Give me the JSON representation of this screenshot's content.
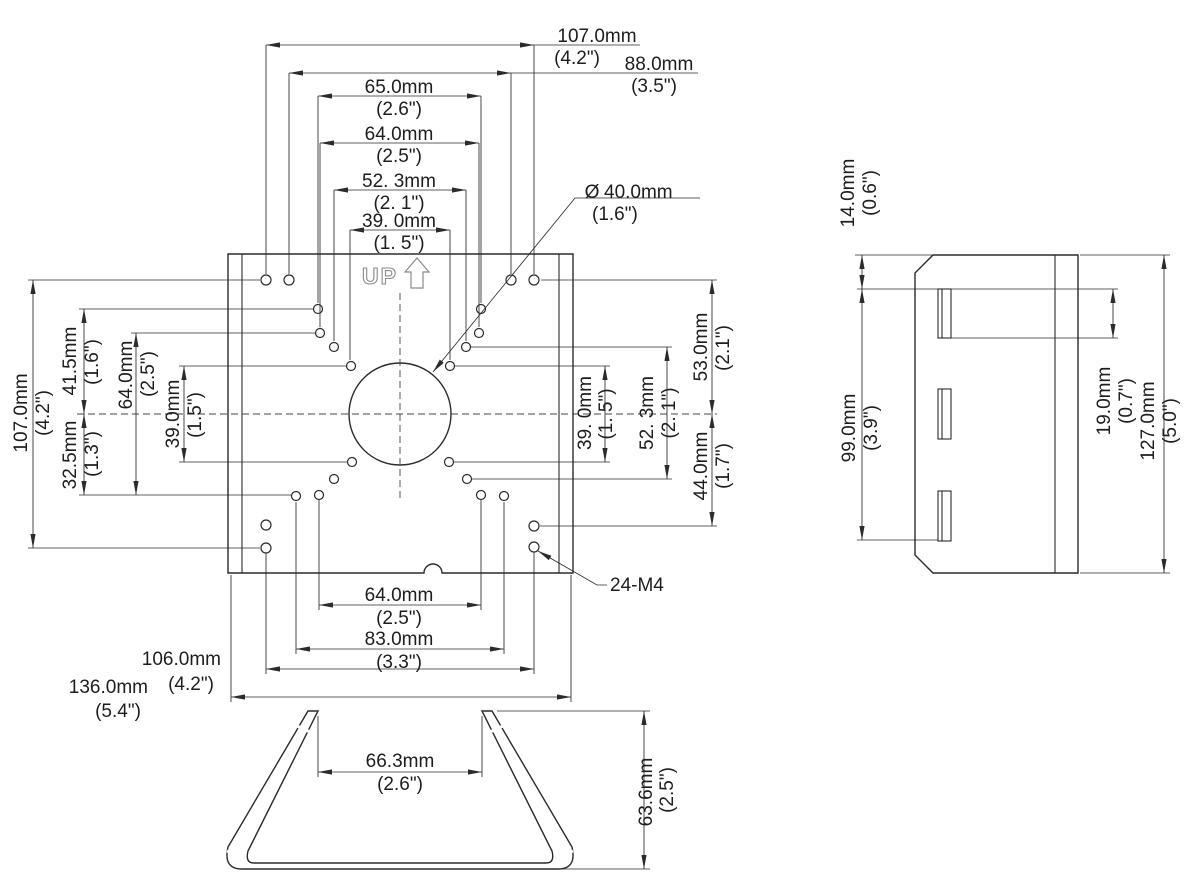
{
  "drawing": {
    "front": {
      "up_label": "UP",
      "top_dims": [
        {
          "mm": "107.0mm",
          "in": "(4.2\")"
        },
        {
          "mm": "88.0mm",
          "in": "(3.5\")"
        },
        {
          "mm": "65.0mm",
          "in": "(2.6\")"
        },
        {
          "mm": "64.0mm",
          "in": "(2.5\")"
        },
        {
          "mm": "52. 3mm",
          "in": "(2. 1\")"
        },
        {
          "mm": "39. 0mm",
          "in": "(1. 5\")"
        }
      ],
      "left_dims": [
        {
          "mm": "107.0mm",
          "in": "(4.2\")"
        },
        {
          "mm": "41.5mm",
          "in": "(1.6\")"
        },
        {
          "mm": "32.5mm",
          "in": "(1.3\")"
        },
        {
          "mm": "64.0mm",
          "in": "(2.5\")"
        },
        {
          "mm": "39.0mm",
          "in": "(1.5\")"
        }
      ],
      "right_dims": [
        {
          "mm": "53.0mm",
          "in": "(2.1\")"
        },
        {
          "mm": "44.0mm",
          "in": "(1.7\")"
        },
        {
          "mm": "39. 0mm",
          "in": "(1. 5\")"
        },
        {
          "mm": "52. 3mm",
          "in": "(2. 1\")"
        }
      ],
      "bottom_dims": [
        {
          "mm": "64.0mm",
          "in": "(2.5\")"
        },
        {
          "mm": "83.0mm",
          "in": "(3.3\")"
        },
        {
          "mm": "106.0mm",
          "in": "(4.2\")"
        },
        {
          "mm": "136.0mm",
          "in": "(5.4\")"
        }
      ],
      "annotations": {
        "diameter_symbol": "Ø",
        "diameter": {
          "mm": "40.0mm",
          "in": "(1.6\")"
        },
        "thread_callout": "24-M4"
      }
    },
    "side": {
      "dims": [
        {
          "mm": "14.0mm",
          "in": "(0.6\")"
        },
        {
          "mm": "99.0mm",
          "in": "(3.9\")"
        },
        {
          "mm": "19.0mm",
          "in": "(0.7\")"
        },
        {
          "mm": "127.0mm",
          "in": "(5.0\")"
        }
      ]
    },
    "bottom": {
      "dims": [
        {
          "mm": "66.3mm",
          "in": "(2.6\")"
        },
        {
          "mm": "63.6mm",
          "in": "(2.5\")"
        }
      ]
    }
  },
  "colors": {
    "line": "#2b2b2b",
    "muted": "#8a8a8a",
    "background": "#ffffff"
  }
}
